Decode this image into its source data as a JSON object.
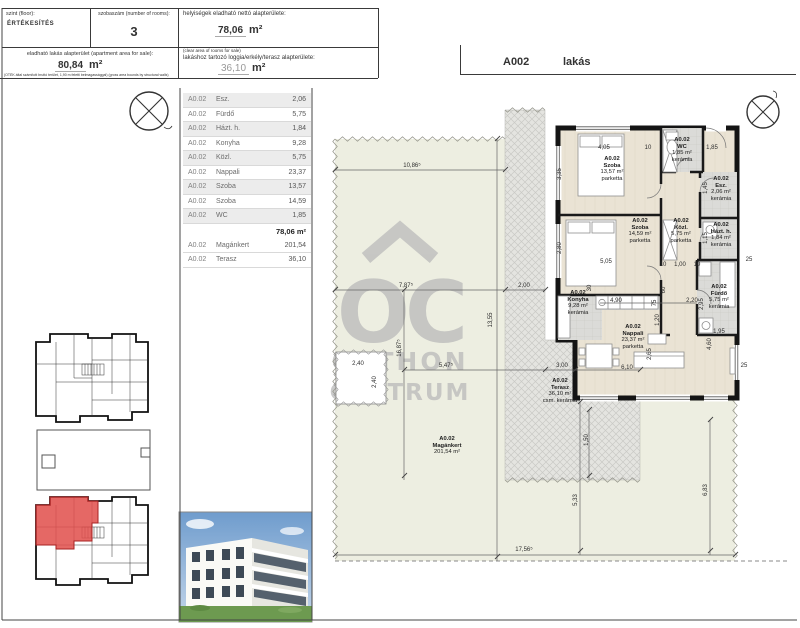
{
  "header": {
    "floor_label": "szint (floor):",
    "floor_value": "ÉRTÉKESÍTÉS",
    "rooms_label": "szobaszám (number of rooms):",
    "rooms_value": "3",
    "net_area_label": "helyiségek eladható nettó alapterülete:",
    "net_area_value": "78,06",
    "net_area_unit": "m²",
    "net_area_note": "(clear area of rooms for sale)",
    "sale_area_label": "eladható lakás alapterület (apartment area for sale):",
    "sale_area_value": "80,84",
    "sale_area_unit": "m²",
    "sale_area_note": "(OTÉK által számított bruttó terület, 1,90 m feletti belmagassággal) (gross area bounds by structural walls)",
    "terrace_label": "lakáshoz tartozó loggia/erkély/terasz alapterülete:",
    "terrace_value": "36,10",
    "terrace_unit": "m²"
  },
  "title_block": {
    "unit_id": "A002",
    "unit_type": "lakás"
  },
  "room_table": {
    "rows": [
      {
        "unit": "A0.02",
        "name": "Esz.",
        "area": "2,06"
      },
      {
        "unit": "A0.02",
        "name": "Fürdő",
        "area": "5,75"
      },
      {
        "unit": "A0.02",
        "name": "Házt. h.",
        "area": "1,84"
      },
      {
        "unit": "A0.02",
        "name": "Konyha",
        "area": "9,28"
      },
      {
        "unit": "A0.02",
        "name": "Közl.",
        "area": "5,75"
      },
      {
        "unit": "A0.02",
        "name": "Nappali",
        "area": "23,37"
      },
      {
        "unit": "A0.02",
        "name": "Szoba",
        "area": "13,57"
      },
      {
        "unit": "A0.02",
        "name": "Szoba",
        "area": "14,59"
      },
      {
        "unit": "A0.02",
        "name": "WC",
        "area": "1,85"
      }
    ],
    "total": "78,06 m²",
    "extra_rows": [
      {
        "unit": "A0.02",
        "name": "Magánkert",
        "area": "201,54"
      },
      {
        "unit": "A0.02",
        "name": "Terasz",
        "area": "36,10"
      }
    ]
  },
  "watermark": {
    "monogram": "OC",
    "line1": "OTTHON",
    "line2": "CENTRUM"
  },
  "plan": {
    "unit_code": "A0.02",
    "room_labels": [
      {
        "x": 612,
        "y": 156,
        "lines": [
          "A0.02",
          "Szoba",
          "13,57 m²",
          "parketta"
        ]
      },
      {
        "x": 640,
        "y": 218,
        "lines": [
          "A0.02",
          "Szoba",
          "14,59 m²",
          "parketta"
        ]
      },
      {
        "x": 682,
        "y": 137,
        "lines": [
          "A0.02",
          "WC",
          "1,85 m²",
          "kerámia"
        ]
      },
      {
        "x": 721,
        "y": 176,
        "lines": [
          "A0.02",
          "Esz.",
          "2,06 m²",
          "kerámia"
        ]
      },
      {
        "x": 721,
        "y": 222,
        "lines": [
          "A0.02",
          "Házt. h.",
          "1,84 m²",
          "kerámia"
        ]
      },
      {
        "x": 719,
        "y": 284,
        "lines": [
          "A0.02",
          "Fürdő",
          "5,75 m²",
          "kerámia"
        ]
      },
      {
        "x": 681,
        "y": 218,
        "lines": [
          "A0.02",
          "Közl.",
          "5,75 m²",
          "parketta"
        ]
      },
      {
        "x": 578,
        "y": 290,
        "lines": [
          "A0.02",
          "Konyha",
          "9,28 m²",
          "kerámia"
        ]
      },
      {
        "x": 633,
        "y": 324,
        "lines": [
          "A0.02",
          "Nappali",
          "23,37 m²",
          "parketta"
        ]
      },
      {
        "x": 560,
        "y": 378,
        "lines": [
          "A0.02",
          "Terasz",
          "36,10 m²",
          "csm. kerámia"
        ]
      },
      {
        "x": 447,
        "y": 436,
        "lines": [
          "A0.02",
          "Magánkert",
          "201,54 m²"
        ]
      }
    ],
    "dims": [
      {
        "t": "10,86⁵",
        "x": 412,
        "y": 166
      },
      {
        "t": "7,87⁵",
        "x": 406,
        "y": 286
      },
      {
        "t": "2,00",
        "x": 524,
        "y": 286
      },
      {
        "t": "13,55",
        "x": 491,
        "y": 320,
        "r": 1
      },
      {
        "t": "16,87⁵",
        "x": 400,
        "y": 348,
        "r": 1
      },
      {
        "t": "5,47⁵",
        "x": 446,
        "y": 366
      },
      {
        "t": "3,00",
        "x": 562,
        "y": 366
      },
      {
        "t": "2,40",
        "x": 358,
        "y": 364
      },
      {
        "t": "2,40",
        "x": 375,
        "y": 382,
        "r": 1
      },
      {
        "t": "17,56⁵",
        "x": 524,
        "y": 550
      },
      {
        "t": "5,33",
        "x": 576,
        "y": 500,
        "r": 1
      },
      {
        "t": "6,83",
        "x": 706,
        "y": 490,
        "r": 1
      },
      {
        "t": "1,50",
        "x": 587,
        "y": 440,
        "r": 1
      },
      {
        "t": "4,05",
        "x": 604,
        "y": 148
      },
      {
        "t": "10",
        "x": 648,
        "y": 148
      },
      {
        "t": "1,85",
        "x": 712,
        "y": 148
      },
      {
        "t": "3,35",
        "x": 560,
        "y": 174,
        "r": 1
      },
      {
        "t": "5,05",
        "x": 606,
        "y": 262
      },
      {
        "t": "2,80",
        "x": 560,
        "y": 248,
        "r": 1
      },
      {
        "t": "1,45",
        "x": 706,
        "y": 188,
        "r": 1
      },
      {
        "t": "1,15",
        "x": 706,
        "y": 238,
        "r": 1
      },
      {
        "t": "2,95",
        "x": 702,
        "y": 304,
        "r": 1
      },
      {
        "t": "1,95",
        "x": 719,
        "y": 332
      },
      {
        "t": "25",
        "x": 749,
        "y": 260
      },
      {
        "t": "25",
        "x": 744,
        "y": 366
      },
      {
        "t": "30",
        "x": 590,
        "y": 288,
        "r": 1
      },
      {
        "t": "60",
        "x": 664,
        "y": 290,
        "r": 1
      },
      {
        "t": "4,90",
        "x": 616,
        "y": 301
      },
      {
        "t": "75",
        "x": 655,
        "y": 303,
        "r": 1
      },
      {
        "t": "2,20",
        "x": 692,
        "y": 301
      },
      {
        "t": "1,20",
        "x": 658,
        "y": 320,
        "r": 1
      },
      {
        "t": "2,65",
        "x": 650,
        "y": 354,
        "r": 1
      },
      {
        "t": "6,10",
        "x": 627,
        "y": 368
      },
      {
        "t": "4,60",
        "x": 710,
        "y": 344,
        "r": 1
      },
      {
        "t": "10",
        "x": 663,
        "y": 265
      },
      {
        "t": "1,00",
        "x": 680,
        "y": 265
      },
      {
        "t": "10",
        "x": 697,
        "y": 265
      }
    ]
  }
}
